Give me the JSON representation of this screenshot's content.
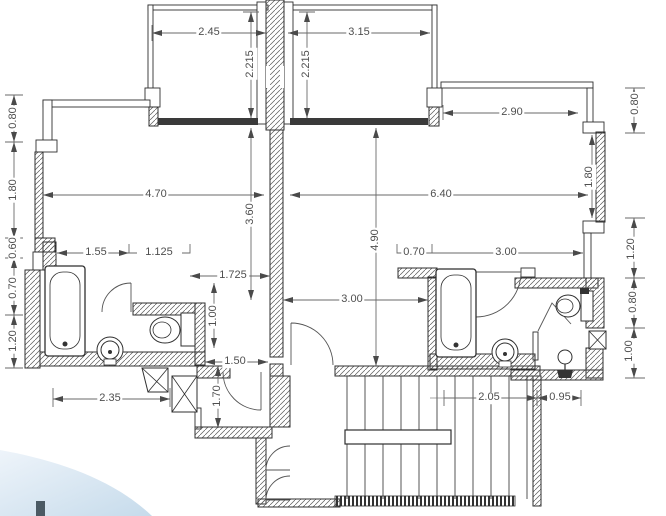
{
  "drawing": {
    "type": "architectural-floor-plan",
    "units": "meters",
    "wall_line_color": "#2f2f2f",
    "hatch_color": "#5a5a5a",
    "dim_line_color": "#6a6a6a",
    "dim_text_color": "#4f4f4f",
    "dark_band_color": "#3a3a3a",
    "corner_photo_color": "#cadeed"
  },
  "fixtures": {
    "bathtub_left": "bathtub",
    "bathtub_right": "bathtub",
    "toilet_left": "toilet",
    "toilet_right": "toilet",
    "sink_left": "round-basin",
    "sink_right": "round-basin",
    "pedestal_basin": "pedestal-basin",
    "stairs": "staircase-with-landing",
    "shafts": "duct-shaft-x-box"
  },
  "dims": [
    {
      "id": "top-left-room-width",
      "v": "2.45"
    },
    {
      "id": "top-right-room-width",
      "v": "3.15"
    },
    {
      "id": "top-left-room-depth",
      "v": "2.215"
    },
    {
      "id": "top-right-room-depth",
      "v": "2.215"
    },
    {
      "id": "right-terrace-width",
      "v": "2.90"
    },
    {
      "id": "left-upper-offset",
      "v": "0.80"
    },
    {
      "id": "left-living-span",
      "v": "1.80"
    },
    {
      "id": "left-step",
      "v": "0.60"
    },
    {
      "id": "left-bath-upper",
      "v": "0.70"
    },
    {
      "id": "left-bath-lower",
      "v": "1.20"
    },
    {
      "id": "left-room-width",
      "v": "4.70"
    },
    {
      "id": "right-room-width",
      "v": "6.40"
    },
    {
      "id": "center-left-span",
      "v": "3.60"
    },
    {
      "id": "right-hall-span",
      "v": "4.90"
    },
    {
      "id": "left-wall-a",
      "v": "1.55"
    },
    {
      "id": "left-wall-b",
      "v": "1.125"
    },
    {
      "id": "left-hall-width",
      "v": "1.725"
    },
    {
      "id": "right-pier-width",
      "v": "0.70"
    },
    {
      "id": "right-bath-zone-width",
      "v": "3.00"
    },
    {
      "id": "right-hall-width",
      "v": "3.00"
    },
    {
      "id": "left-hall-depth",
      "v": "1.00"
    },
    {
      "id": "left-corridor-width",
      "v": "1.50"
    },
    {
      "id": "left-entry-depth",
      "v": "1.70"
    },
    {
      "id": "left-bath-outer-width",
      "v": "2.35"
    },
    {
      "id": "stair-flight-width",
      "v": "2.05"
    },
    {
      "id": "wc-width",
      "v": "0.95"
    },
    {
      "id": "right-upper-offset",
      "v": "0.80"
    },
    {
      "id": "right-window-span",
      "v": "1.80"
    },
    {
      "id": "right-recess",
      "v": "1.20"
    },
    {
      "id": "right-wc-upper",
      "v": "0.80"
    },
    {
      "id": "right-wc-lower",
      "v": "1.00"
    }
  ]
}
